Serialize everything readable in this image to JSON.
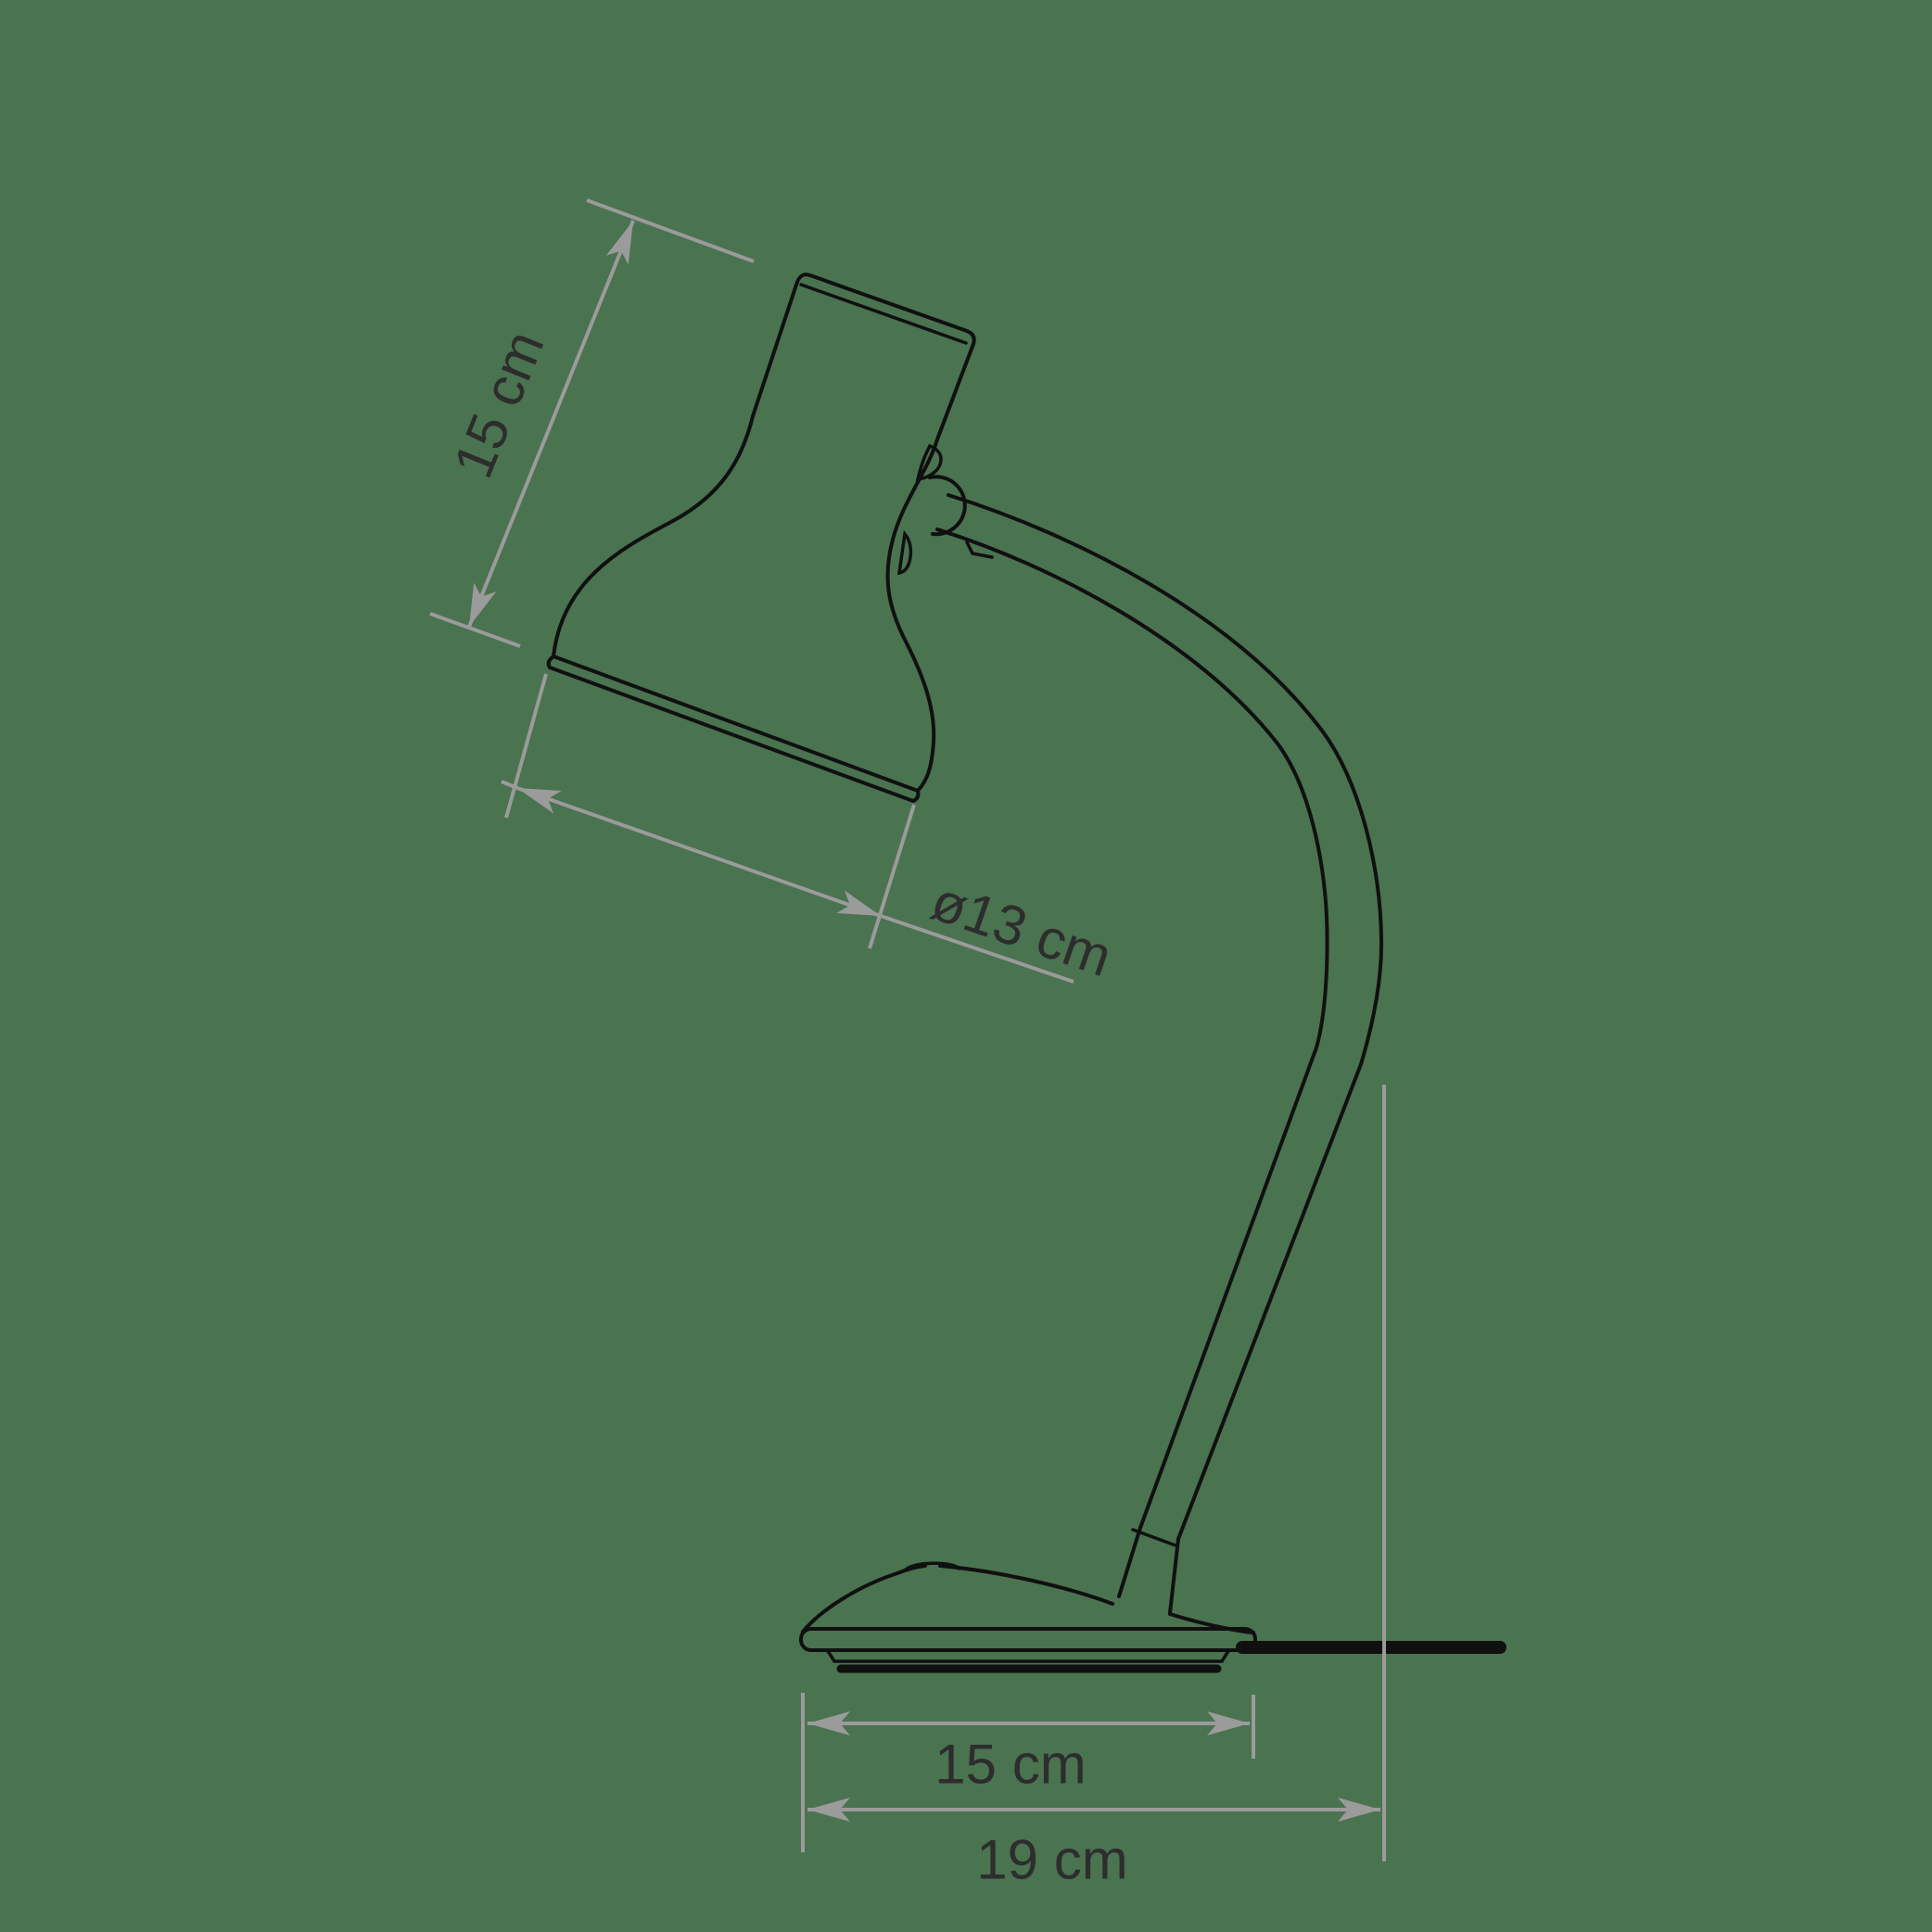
{
  "scene": {
    "description": "Technical line drawing of a desk table lamp with dimension annotations",
    "background_color": "#4A7350",
    "outline_color": "#101010",
    "dimension_line_color": "#9B9B9B",
    "label_color": "#2D2D2D"
  },
  "labels": {
    "shade_height": "15 cm",
    "shade_diameter": "ø13 cm",
    "base_width": "15 cm",
    "overall_depth": "19 cm"
  }
}
